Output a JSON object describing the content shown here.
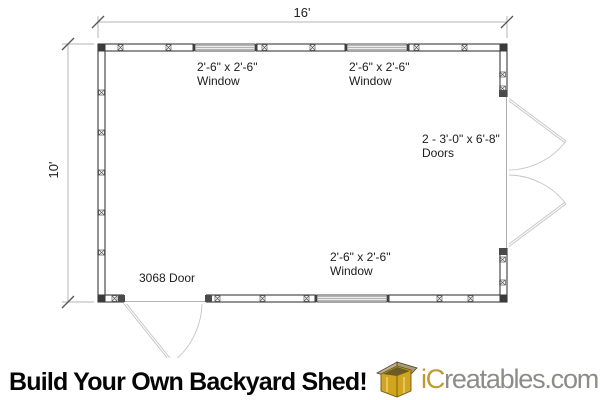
{
  "plan": {
    "dim_width": "16'",
    "dim_height": "10'",
    "windows": [
      {
        "size": "2'-6\" x 2'-6\"",
        "label": "Window"
      },
      {
        "size": "2'-6\" x 2'-6\"",
        "label": "Window"
      },
      {
        "size": "2'-6\" x 2'-6\"",
        "label": "Window"
      }
    ],
    "double_door": {
      "size": "2 - 3'-0\" x 6'-8\"",
      "label": "Doors"
    },
    "single_door": {
      "label": "3068 Door"
    }
  },
  "footer": {
    "headline": "Build Your Own Backyard Shed!",
    "brand": {
      "prefix": "iC",
      "suffix": "reatables.com"
    },
    "logo_icon": "shed-icon"
  },
  "colors": {
    "wall_line": "#3b3b3b",
    "dimension_line": "#b5b5b5",
    "door_swing": "#c4c4c4",
    "brand_gold": "#c2992d",
    "brand_gray": "#8d8d87",
    "icon_wall_gold": "#d2a51c",
    "icon_roof_tan": "#b3a78c",
    "headline_black": "#050505"
  }
}
